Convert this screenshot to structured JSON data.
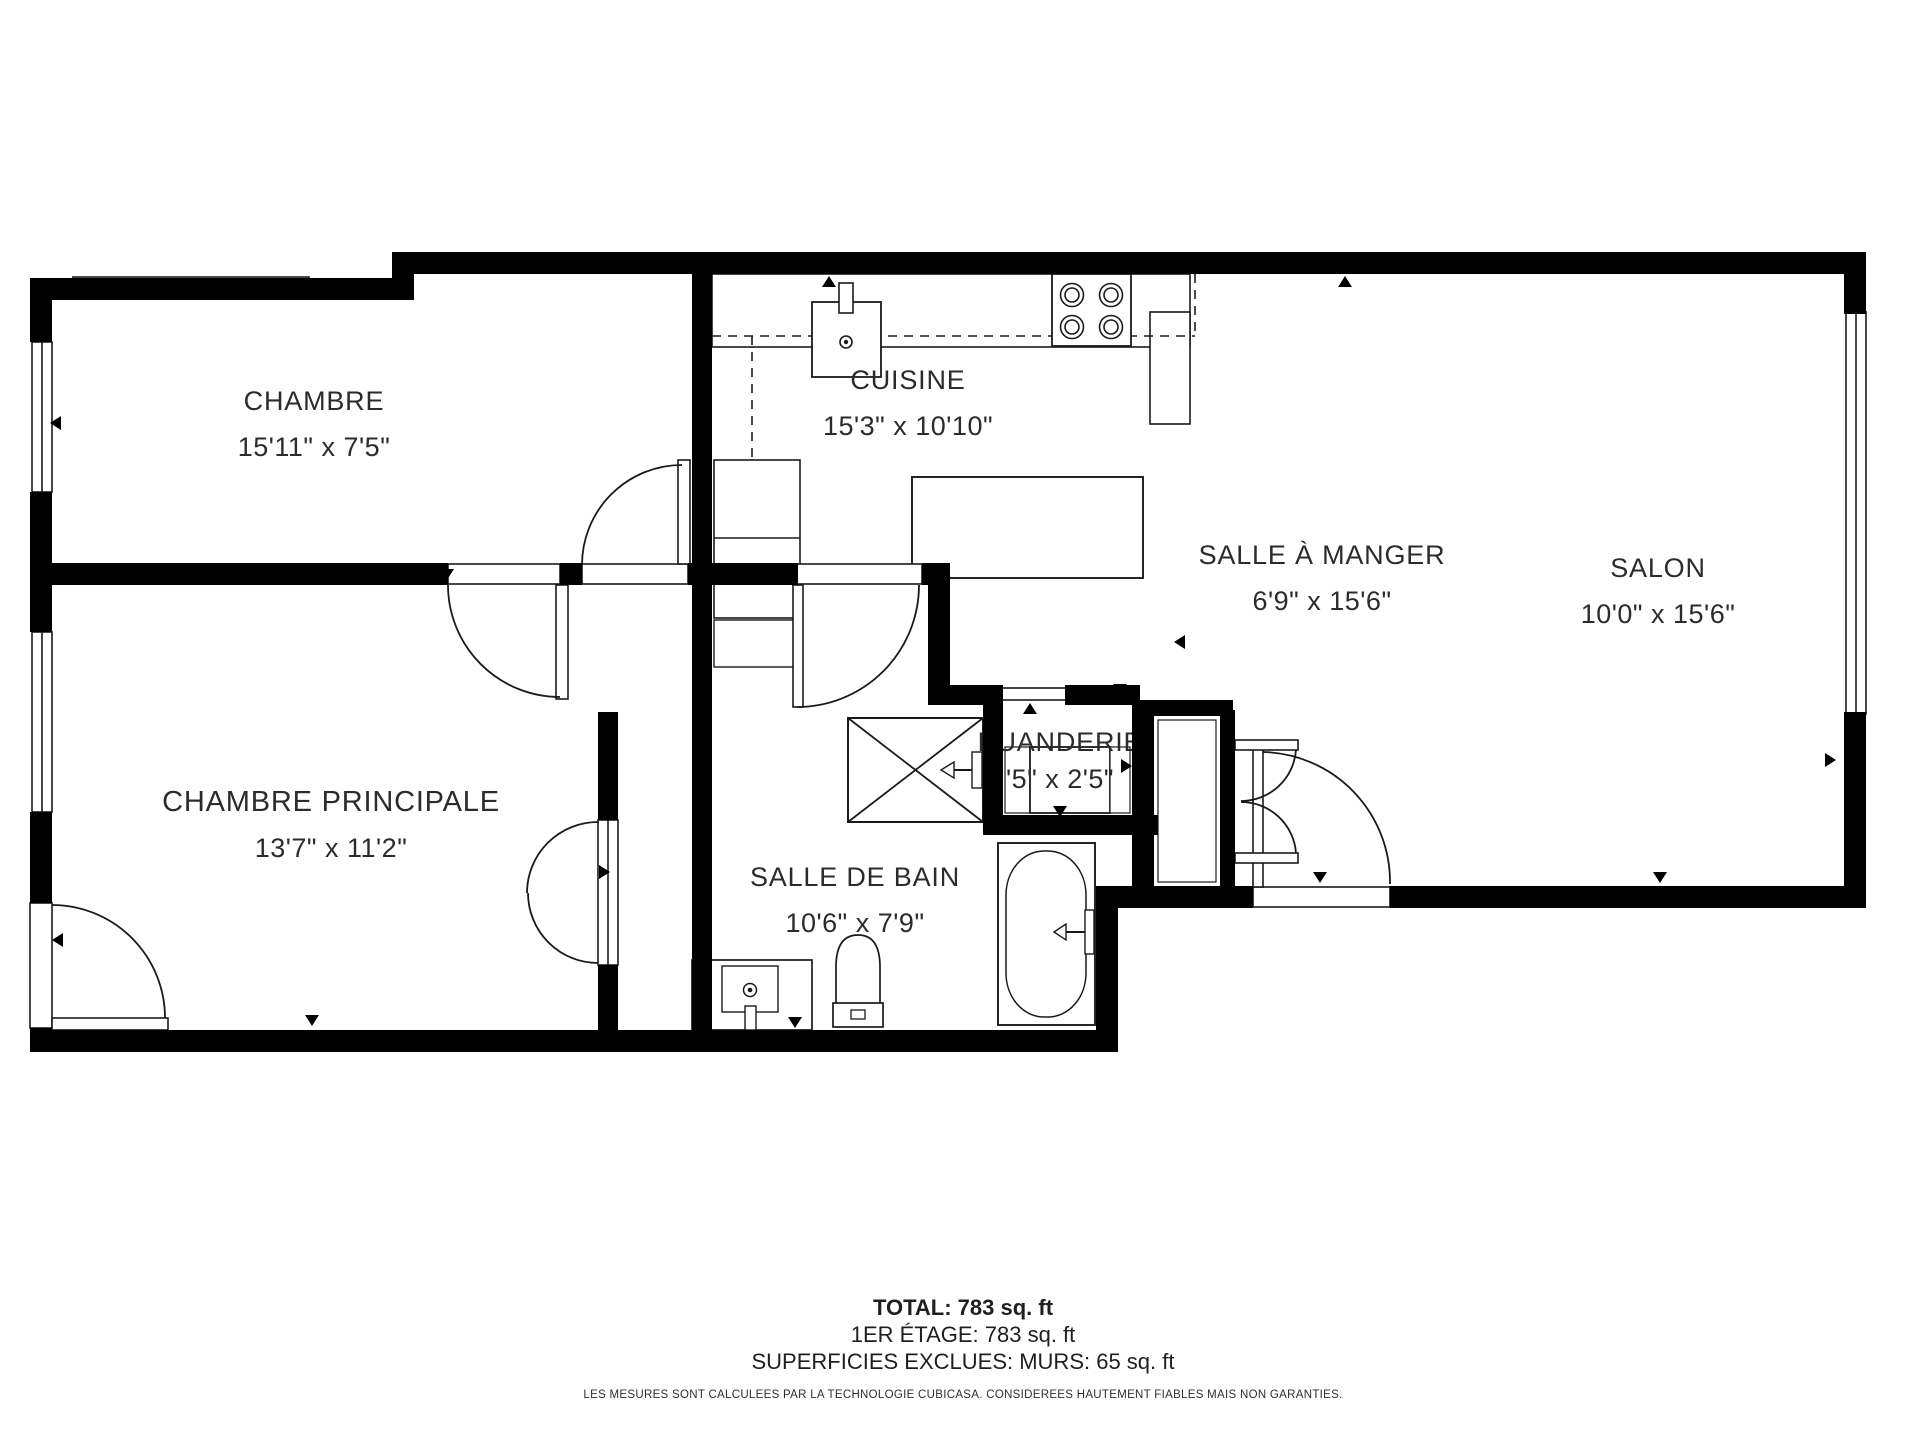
{
  "rooms": {
    "chambre": {
      "label": "CHAMBRE",
      "dims": "15'11\" x 7'5\""
    },
    "cuisine": {
      "label": "CUISINE",
      "dims": "15'3\" x 10'10\""
    },
    "manger": {
      "label": "SALLE À MANGER",
      "dims": "6'9\" x 15'6\""
    },
    "salon": {
      "label": "SALON",
      "dims": "10'0\" x 15'6\""
    },
    "principale": {
      "label": "CHAMBRE PRINCIPALE",
      "dims": "13'7\" x 11'2\""
    },
    "bain": {
      "label": "SALLE DE BAIN",
      "dims": "10'6\" x 7'9\""
    },
    "buanderie": {
      "label": "BUANDERIE",
      "dims": "'5\" x 2'5\""
    }
  },
  "footer": {
    "total": "TOTAL: 783 sq. ft",
    "floor": "1ER ÉTAGE: 783 sq. ft",
    "excluded": "SUPERFICIES EXCLUES: MURS: 65 sq. ft",
    "disclaimer": "LES MESURES SONT CALCULEES PAR LA TECHNOLOGIE CUBICASA. CONSIDEREES HAUTEMENT FIABLES MAIS NON GARANTIES."
  },
  "colors": {
    "wall": "#000000",
    "background": "#ffffff",
    "line": "#1a1a1a",
    "text": "#2b2b2b"
  }
}
